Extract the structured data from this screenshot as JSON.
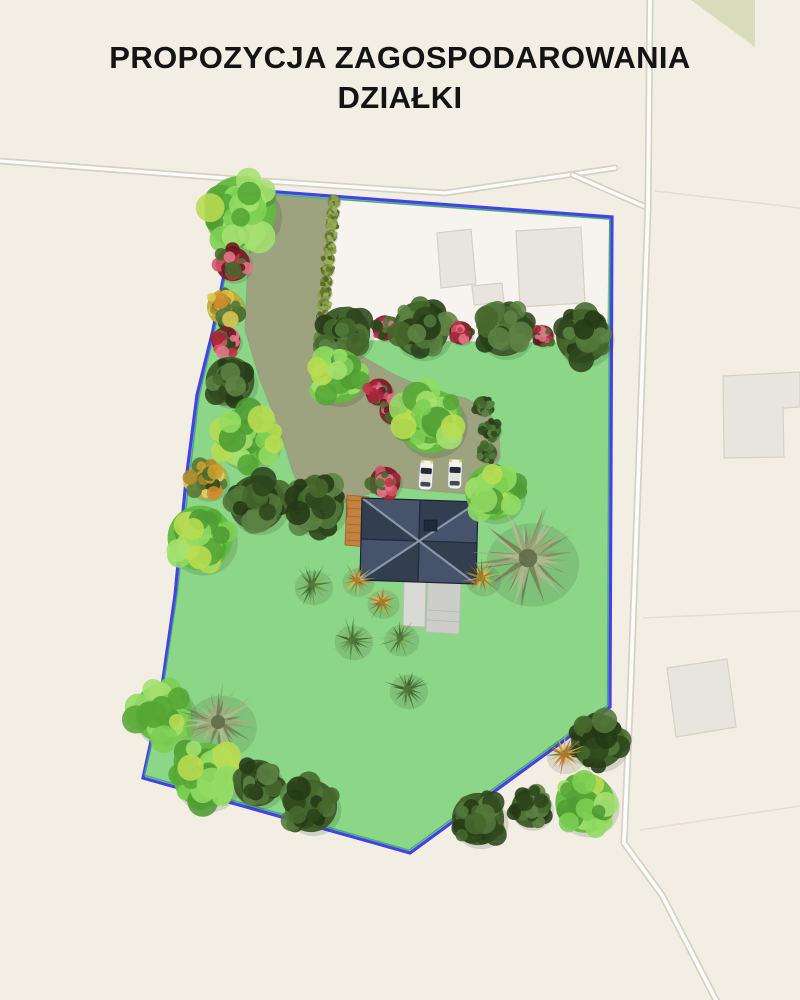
{
  "title": "PROPOZYCJA ZAGOSPODAROWANIA DZIAŁKI",
  "colors": {
    "bg": "#f3eee4",
    "map_white": "#f7f4ef",
    "road_fill": "#fcfcf9",
    "road_casing": "#d6d0c5",
    "parcel_line": "#e4ddd0",
    "building_fill": "#e8e4de",
    "building_stroke": "#d6d0c6",
    "green_patch": "#d9dcba",
    "lawn": "#8bd687",
    "boundary_blue": "#4342e4",
    "boundary_teal": "#3f9c8c",
    "driveway": "#9da27f",
    "driveway_edge": "#8a8f6a",
    "roof_light": "#46536b",
    "roof_dark": "#333e51",
    "roof_ridge": "#8e99ac",
    "roof_valley": "#222c3c",
    "roof_outline": "#1c2533",
    "chimney": "#20293a",
    "deck": "#c2813f",
    "deck_line": "#9e6128",
    "terrace1": "#d9d9d5",
    "terrace2": "#cdcdc9",
    "terrace_stroke": "#bcbcb6",
    "car_body": "#f4f4ee",
    "car_glass": "#262c36",
    "car_roof": "#e4e4de",
    "car_stroke": "#9aa0a8",
    "car_light": "#e8d44f",
    "title_color": "#141414"
  },
  "site_plan": {
    "canvas": [
      800,
      1000
    ],
    "plot": [
      [
        237,
        189
      ],
      [
        612,
        217
      ],
      [
        610,
        707
      ],
      [
        410,
        853
      ],
      [
        143,
        778
      ],
      [
        160,
        700
      ],
      [
        175,
        595
      ],
      [
        186,
        480
      ],
      [
        197,
        395
      ],
      [
        213,
        330
      ],
      [
        225,
        270
      ]
    ],
    "white_area": [
      [
        336,
        200
      ],
      [
        609,
        220
      ],
      [
        607,
        343
      ],
      [
        355,
        340
      ],
      [
        326,
        318
      ]
    ],
    "driveway": [
      [
        258,
        195
      ],
      [
        333,
        200
      ],
      [
        327,
        260
      ],
      [
        323,
        316
      ],
      [
        345,
        340
      ],
      [
        365,
        358
      ],
      [
        395,
        375
      ],
      [
        430,
        390
      ],
      [
        465,
        398
      ],
      [
        488,
        410
      ],
      [
        499,
        432
      ],
      [
        500,
        458
      ],
      [
        488,
        481
      ],
      [
        468,
        494
      ],
      [
        430,
        491
      ],
      [
        398,
        487
      ],
      [
        368,
        494
      ],
      [
        338,
        505
      ],
      [
        305,
        498
      ],
      [
        293,
        473
      ],
      [
        280,
        430
      ],
      [
        260,
        380
      ],
      [
        245,
        330
      ],
      [
        248,
        260
      ]
    ],
    "green_patch": [
      [
        691,
        0
      ],
      [
        755,
        0
      ],
      [
        755,
        47
      ]
    ],
    "roads": [
      {
        "name": "road-top",
        "pts": [
          [
            0,
            161
          ],
          [
            250,
            180
          ],
          [
            445,
            193
          ],
          [
            615,
            168
          ]
        ],
        "w": 4.5
      },
      {
        "name": "road-top-branch",
        "pts": [
          [
            573,
            175
          ],
          [
            648,
            208
          ]
        ],
        "w": 4.5
      },
      {
        "name": "road-east",
        "pts": [
          [
            650,
            0
          ],
          [
            648,
            208
          ],
          [
            640,
            430
          ],
          [
            630,
            705
          ],
          [
            624,
            843
          ],
          [
            662,
            895
          ],
          [
            716,
            1000
          ]
        ],
        "w": 5
      }
    ],
    "parcel_lines": [
      [
        [
          655,
          191
        ],
        [
          800,
          208
        ]
      ],
      [
        [
          643,
          618
        ],
        [
          800,
          611
        ]
      ],
      [
        [
          640,
          830
        ],
        [
          800,
          806
        ]
      ]
    ],
    "buildings": [
      [
        [
          437,
          233
        ],
        [
          471,
          229
        ],
        [
          476,
          284
        ],
        [
          441,
          288
        ]
      ],
      [
        [
          472,
          286
        ],
        [
          502,
          283
        ],
        [
          504,
          302
        ],
        [
          474,
          305
        ]
      ],
      [
        [
          516,
          231
        ],
        [
          581,
          227
        ],
        [
          585,
          303
        ],
        [
          520,
          307
        ]
      ],
      [
        [
          723,
          376
        ],
        [
          800,
          372
        ],
        [
          800,
          407
        ],
        [
          783,
          408
        ],
        [
          784,
          457
        ],
        [
          724,
          458
        ]
      ],
      [
        [
          667,
          668
        ],
        [
          727,
          659
        ],
        [
          736,
          727
        ],
        [
          676,
          737
        ]
      ]
    ],
    "house": {
      "roof": [
        [
          362,
          498
        ],
        [
          478,
          502
        ],
        [
          476,
          584
        ],
        [
          360,
          580
        ]
      ],
      "chimney": [
        424,
        520,
        13,
        11
      ],
      "deck": [
        [
          347,
          495
        ],
        [
          369,
          497
        ],
        [
          367,
          547
        ],
        [
          345,
          545
        ]
      ],
      "terraces": [
        [
          [
            404,
            580
          ],
          [
            426,
            581
          ],
          [
            425,
            627
          ],
          [
            403,
            626
          ]
        ],
        [
          [
            428,
            576
          ],
          [
            461,
            579
          ],
          [
            459,
            634
          ],
          [
            426,
            632
          ]
        ]
      ]
    },
    "cars": [
      {
        "cx": 426,
        "cy": 475,
        "w": 14,
        "h": 30,
        "rot": 4
      },
      {
        "cx": 455,
        "cy": 474,
        "w": 14,
        "h": 30,
        "rot": 2
      }
    ],
    "hedge": {
      "from": [
        334,
        202
      ],
      "to": [
        323,
        316
      ],
      "count": 11,
      "r": 7
    },
    "trees": [
      [
        "light",
        240,
        212,
        40
      ],
      [
        "red",
        233,
        264,
        19
      ],
      [
        "yellow",
        225,
        307,
        20
      ],
      [
        "red",
        226,
        341,
        16
      ],
      [
        "dark",
        230,
        381,
        27
      ],
      [
        "light",
        247,
        437,
        34
      ],
      [
        "yellow",
        207,
        479,
        22
      ],
      [
        "dark",
        257,
        503,
        31
      ],
      [
        "dark",
        316,
        505,
        31
      ],
      [
        "light",
        200,
        538,
        36
      ],
      [
        "dark",
        344,
        333,
        29
      ],
      [
        "red",
        385,
        328,
        14
      ],
      [
        "dark",
        421,
        329,
        31
      ],
      [
        "red",
        461,
        333,
        13
      ],
      [
        "dark",
        504,
        330,
        29
      ],
      [
        "red",
        543,
        336,
        12
      ],
      [
        "dark",
        583,
        336,
        30
      ],
      [
        "light",
        338,
        376,
        30
      ],
      [
        "red",
        379,
        392,
        15
      ],
      [
        "red",
        393,
        411,
        15
      ],
      [
        "light",
        430,
        421,
        36
      ],
      [
        "dark",
        483,
        406,
        11
      ],
      [
        "dark",
        491,
        430,
        11
      ],
      [
        "dark",
        487,
        453,
        11
      ],
      [
        "red",
        385,
        482,
        17
      ],
      [
        "light",
        493,
        492,
        31
      ],
      [
        "palm",
        528,
        558,
        58
      ],
      [
        "orange",
        357,
        580,
        20
      ],
      [
        "orange",
        382,
        602,
        20
      ],
      [
        "orange",
        482,
        578,
        22
      ],
      [
        "grass",
        312,
        585,
        24
      ],
      [
        "grass",
        352,
        640,
        24
      ],
      [
        "grass",
        400,
        638,
        22
      ],
      [
        "grass",
        407,
        689,
        24
      ],
      [
        "light",
        163,
        713,
        33
      ],
      [
        "palm",
        218,
        722,
        44
      ],
      [
        "light",
        205,
        775,
        36
      ],
      [
        "dark",
        257,
        783,
        26
      ],
      [
        "dark",
        311,
        806,
        29
      ],
      [
        "dark",
        598,
        741,
        30
      ],
      [
        "orange",
        564,
        754,
        24
      ],
      [
        "light",
        585,
        803,
        33
      ],
      [
        "dark",
        531,
        808,
        22
      ],
      [
        "dark",
        478,
        819,
        29
      ]
    ]
  }
}
